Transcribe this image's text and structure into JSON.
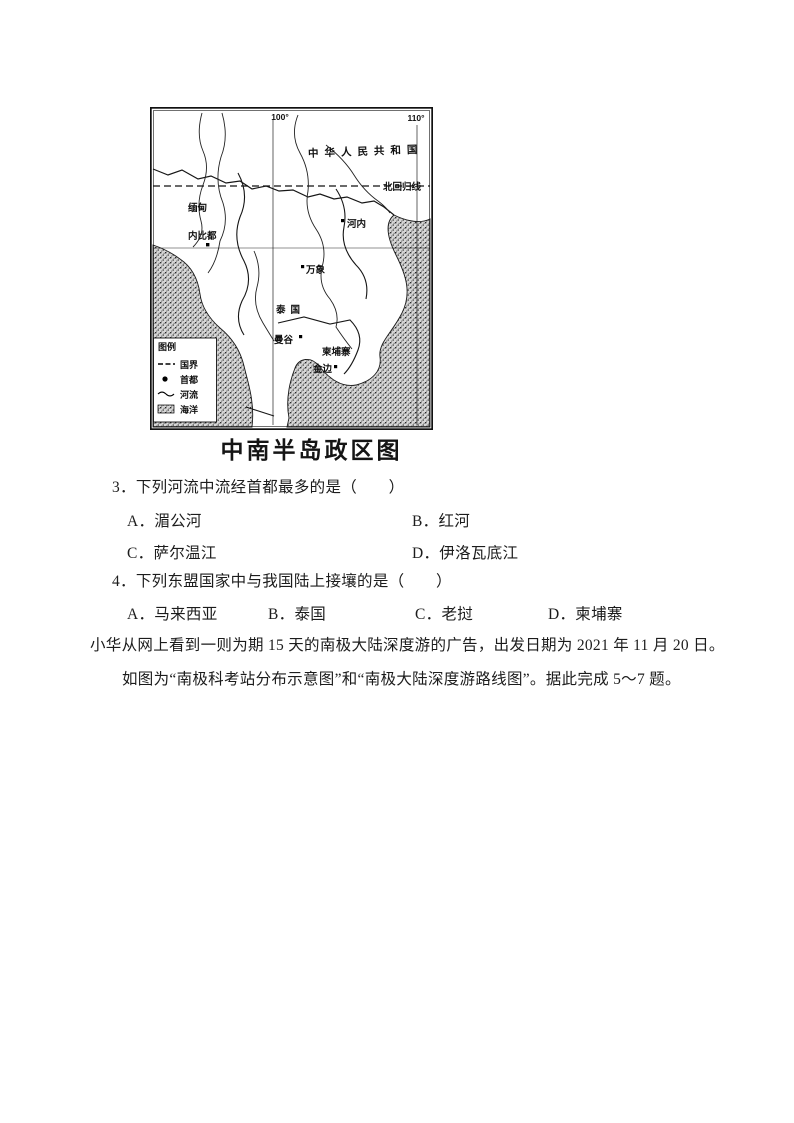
{
  "figure": {
    "caption": "中南半岛政区图",
    "map": {
      "lon_left": "100°",
      "lon_right": "110°",
      "china_label": "中华人民共和国",
      "tropic_label": "北回归线",
      "countries": {
        "myanmar": "缅甸",
        "thailand": "泰国",
        "cambodia": "柬埔寨"
      },
      "capitals": {
        "naypyidaw": "内比都",
        "hanoi": "河内",
        "vientiane": "万象",
        "bangkok": "曼谷",
        "phnom_penh": "金边"
      },
      "legend": {
        "title": "图例",
        "boundary": "国界",
        "capital": "首都",
        "river": "河流",
        "sea": "海洋"
      }
    }
  },
  "questions": [
    {
      "stem": "3．下列河流中流经首都最多的是（　　）",
      "options": [
        "A．湄公河",
        "B．红河",
        "C．萨尔温江",
        "D．伊洛瓦底江"
      ]
    },
    {
      "stem": "4．下列东盟国家中与我国陆上接壤的是（　　）",
      "options": [
        "A．马来西亚",
        "B．泰国",
        "C．老挝",
        "D．柬埔寨"
      ]
    }
  ],
  "passage": {
    "line1": "小华从网上看到一则为期 15 天的南极大陆深度游的广告，出发日期为 2021 年 11 月 20 日。",
    "line2": "如图为“南极科考站分布示意图”和“南极大陆深度游路线图”。据此完成 5～7 题。"
  }
}
